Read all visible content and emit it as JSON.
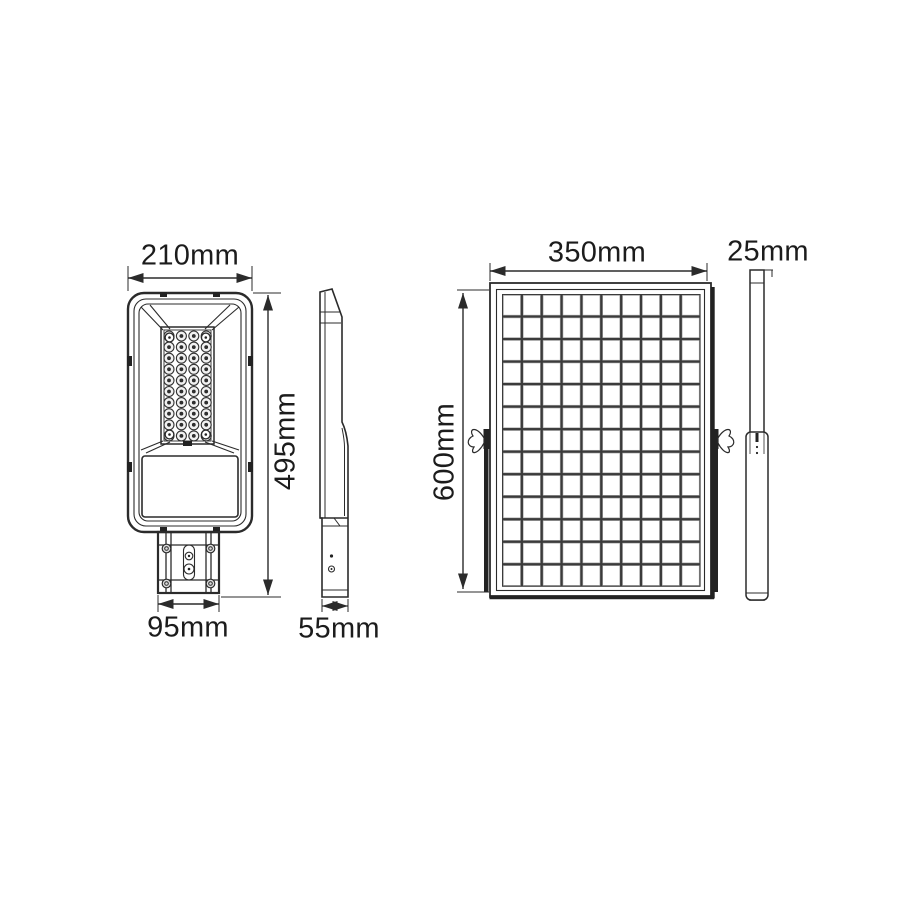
{
  "drawing": {
    "views": {
      "lamp_front": {
        "width_label": "210mm",
        "height_label": "495mm",
        "bracket_width_label": "95mm",
        "led_grid": {
          "cols": 4,
          "rows": 10
        }
      },
      "lamp_side": {
        "depth_label": "55mm"
      },
      "panel_front": {
        "width_label": "350mm",
        "height_label": "600mm",
        "cell_grid": {
          "cols": 10,
          "rows": 13
        }
      },
      "panel_side": {
        "depth_label": "25mm"
      }
    },
    "colors": {
      "line": "#2b2b2b",
      "background": "#ffffff",
      "panel_grid_dark": "#3b3b3b"
    }
  }
}
